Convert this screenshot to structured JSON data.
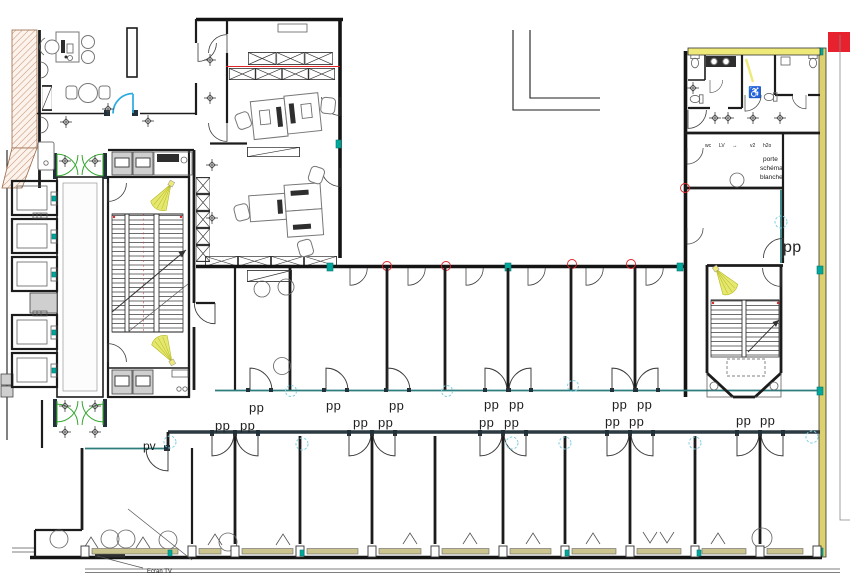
{
  "colors": {
    "wall": "#1c1c1c",
    "blue": "#29abe2",
    "teal": "#00a79d",
    "teal-light": "#7fd0e2",
    "teal-dark": "#2e7d7d",
    "green": "#3aaa35",
    "red": "#e02327",
    "red-marker": "#e8212e",
    "olive": "#ddd06e",
    "yellow": "#efe97a",
    "sill": "#cbc48f",
    "cone": "#dde24a",
    "slate": "#2c3a42",
    "gray-fill": "#cfcfcf",
    "hatch": "#c89070"
  },
  "plan": {
    "annotations": [
      {
        "name": "label-pp",
        "text": "pp",
        "x": 249,
        "y": 412,
        "s": 13
      },
      {
        "name": "label-pp",
        "text": "pp",
        "x": 326,
        "y": 410,
        "s": 13
      },
      {
        "name": "label-pp",
        "text": "pp",
        "x": 389,
        "y": 410,
        "s": 13
      },
      {
        "name": "label-pp",
        "text": "pp",
        "x": 484,
        "y": 409,
        "s": 13
      },
      {
        "name": "label-pp",
        "text": "pp",
        "x": 509,
        "y": 409,
        "s": 13
      },
      {
        "name": "label-pp",
        "text": "pp",
        "x": 612,
        "y": 409,
        "s": 13
      },
      {
        "name": "label-pp",
        "text": "pp",
        "x": 637,
        "y": 409,
        "s": 13
      },
      {
        "name": "label-pp",
        "text": "pp",
        "x": 783,
        "y": 252,
        "s": 16
      },
      {
        "name": "label-pp",
        "text": "pp",
        "x": 215,
        "y": 430,
        "s": 13
      },
      {
        "name": "label-pp",
        "text": "pp",
        "x": 240,
        "y": 430,
        "s": 13
      },
      {
        "name": "label-pp",
        "text": "pp",
        "x": 353,
        "y": 427,
        "s": 13
      },
      {
        "name": "label-pp",
        "text": "pp",
        "x": 378,
        "y": 427,
        "s": 13
      },
      {
        "name": "label-pp",
        "text": "pp",
        "x": 479,
        "y": 427,
        "s": 13
      },
      {
        "name": "label-pp",
        "text": "pp",
        "x": 504,
        "y": 427,
        "s": 13
      },
      {
        "name": "label-pp",
        "text": "pp",
        "x": 605,
        "y": 426,
        "s": 13
      },
      {
        "name": "label-pp",
        "text": "pp",
        "x": 629,
        "y": 426,
        "s": 13
      },
      {
        "name": "label-pp",
        "text": "pp",
        "x": 736,
        "y": 425,
        "s": 13
      },
      {
        "name": "label-pp",
        "text": "pp",
        "x": 760,
        "y": 425,
        "s": 13
      },
      {
        "name": "label-pv",
        "text": "pv",
        "x": 143,
        "y": 450,
        "s": 12
      },
      {
        "name": "label-ecran-tv",
        "text": "Ecran TV",
        "x": 147,
        "y": 573,
        "s": 6
      },
      {
        "name": "label-porte-note",
        "text": "porte",
        "x": 763,
        "y": 161,
        "s": 6.5
      },
      {
        "name": "label-porte-note",
        "text": "schéma",
        "x": 760,
        "y": 170,
        "s": 6.5
      },
      {
        "name": "label-porte-note",
        "text": "blanche",
        "x": 760,
        "y": 179,
        "s": 6.5
      },
      {
        "name": "label-wc-note",
        "text": "wc",
        "x": 705,
        "y": 147,
        "s": 5
      },
      {
        "name": "label-wc-note",
        "text": "LV",
        "x": 719,
        "y": 147,
        "s": 5
      },
      {
        "name": "label-wc-note",
        "text": "→",
        "x": 732,
        "y": 147,
        "s": 5.5
      },
      {
        "name": "label-wc-note",
        "text": "v2",
        "x": 750,
        "y": 147,
        "s": 5
      },
      {
        "name": "label-wc-note",
        "text": "h2o",
        "x": 763,
        "y": 147,
        "s": 5
      },
      {
        "name": "accessible-icon",
        "text": "♿",
        "x": 748,
        "y": 96,
        "s": 11,
        "cls": "wheel"
      }
    ]
  }
}
